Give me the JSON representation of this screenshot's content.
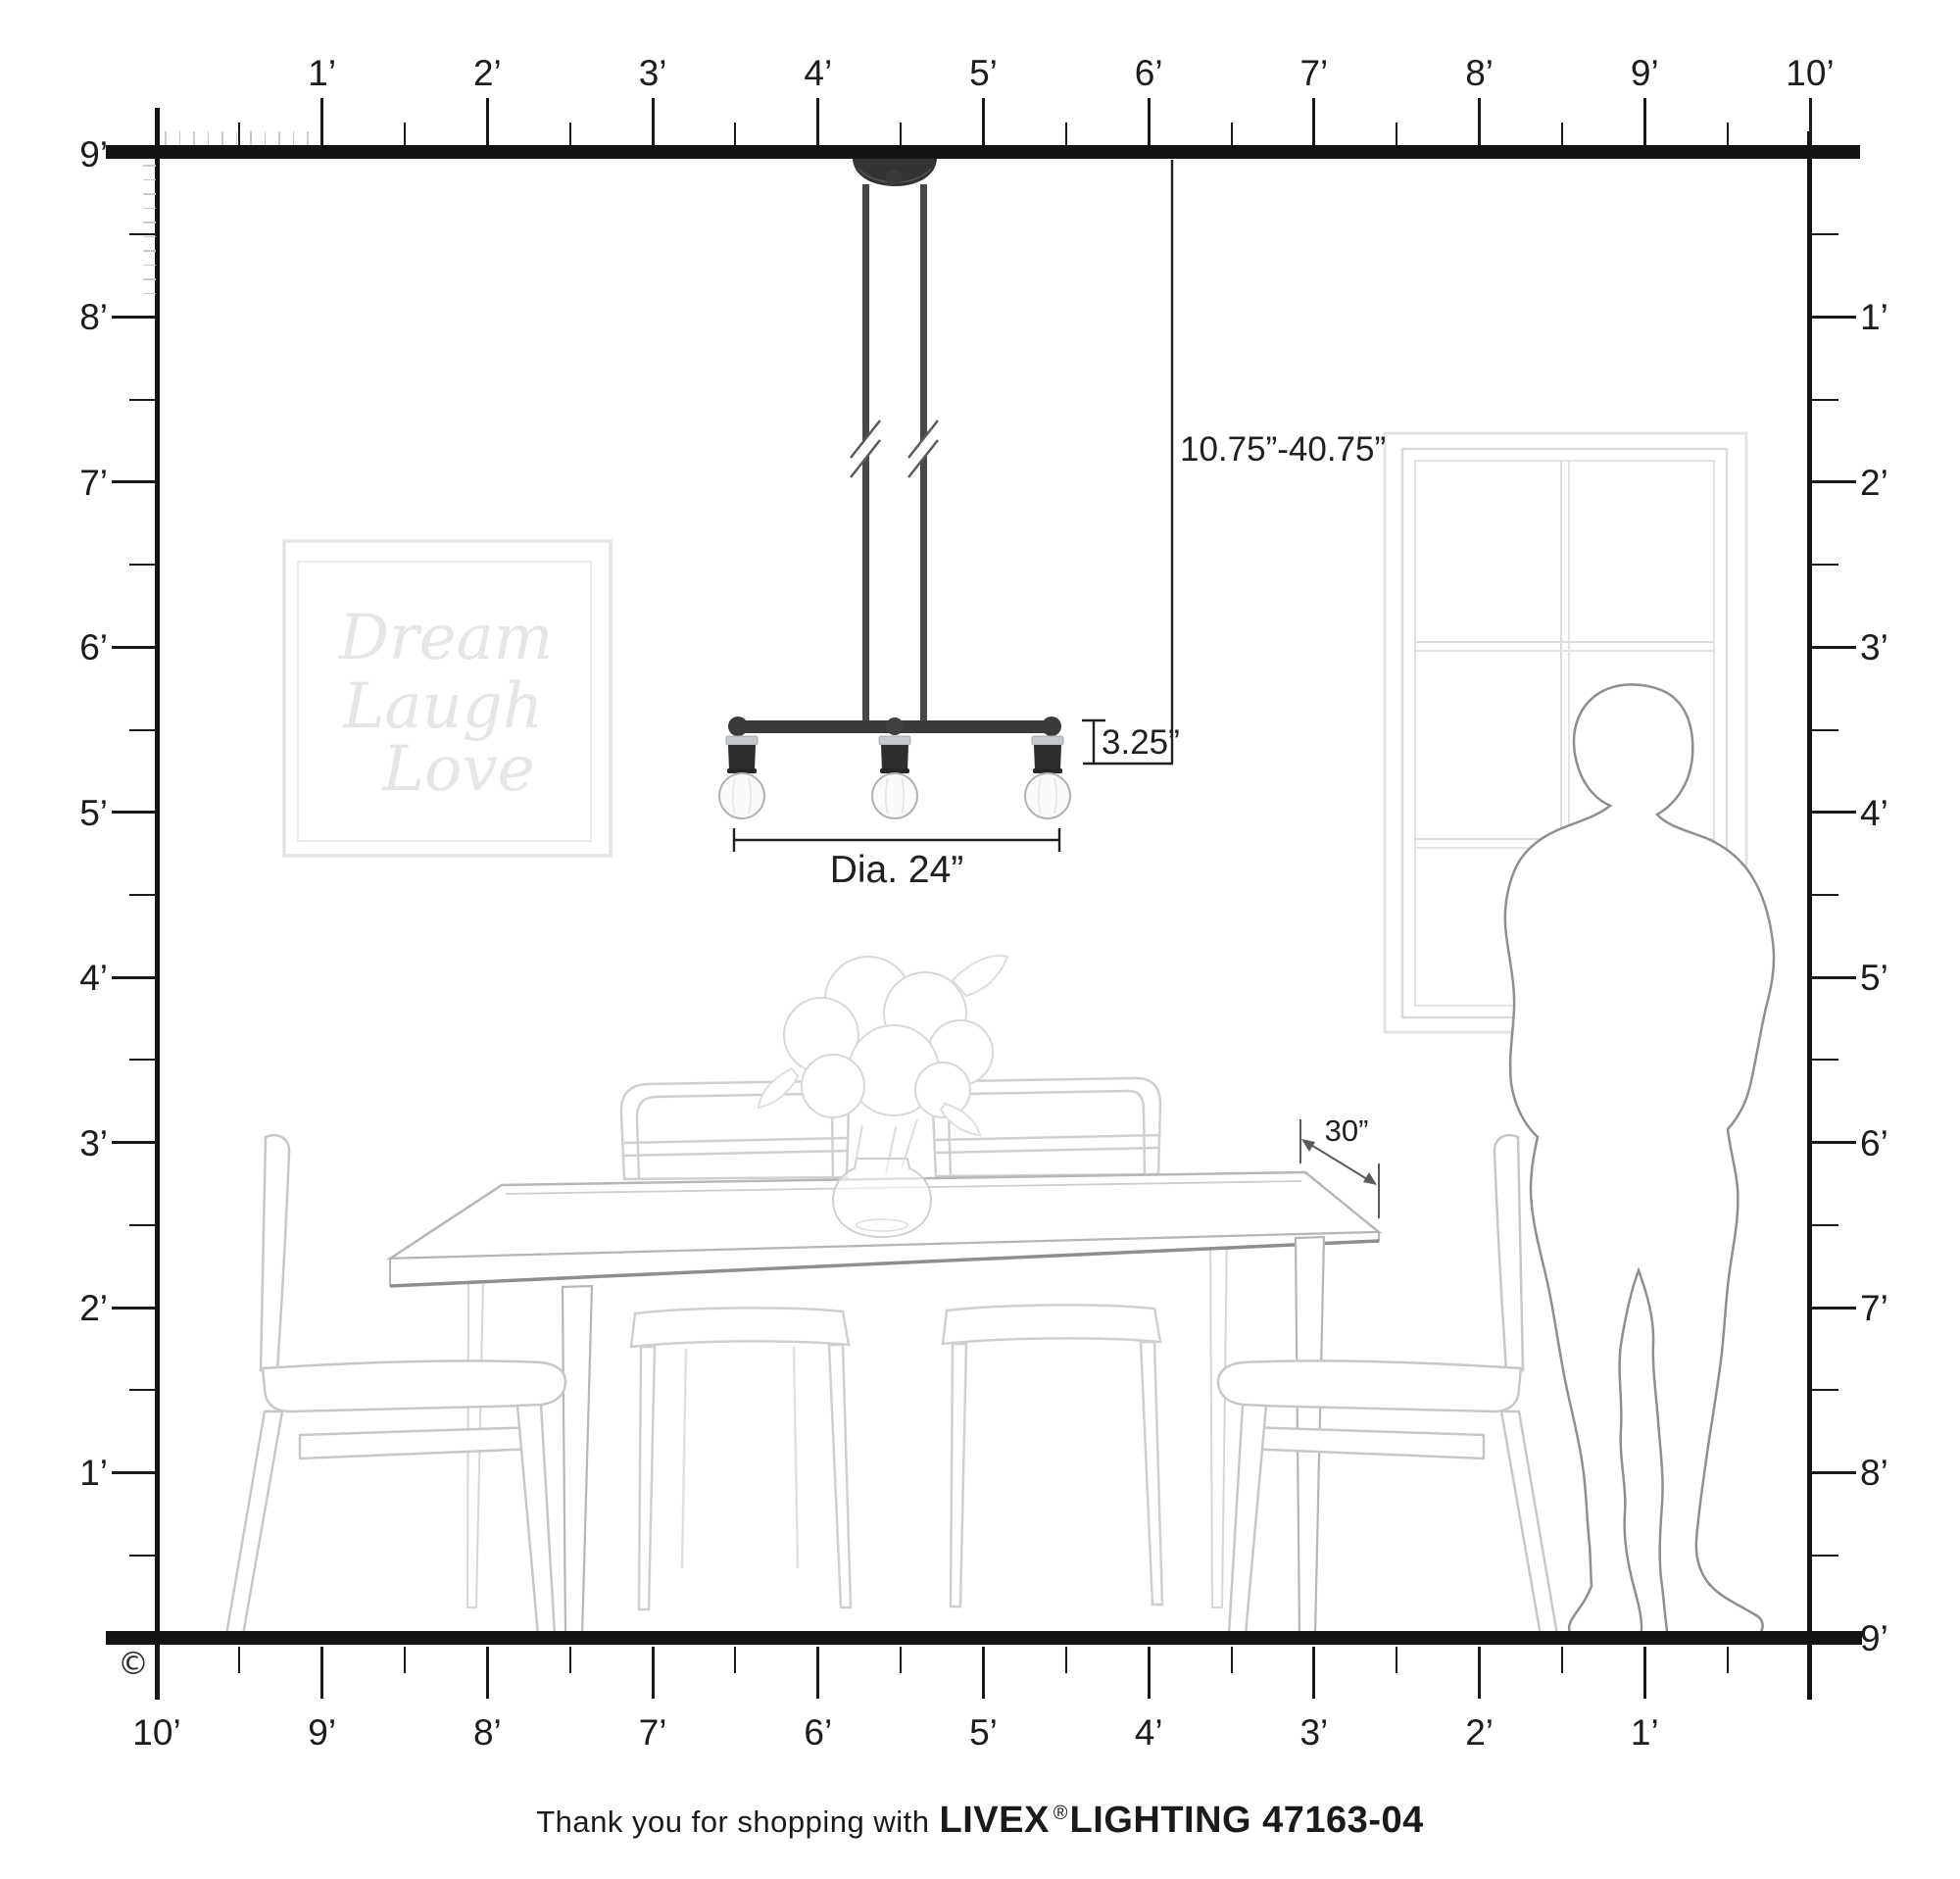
{
  "rulers": {
    "top": [
      "1’",
      "2’",
      "3’",
      "4’",
      "5’",
      "6’",
      "7’",
      "8’",
      "9’",
      "10’"
    ],
    "left": [
      "9’",
      "8’",
      "7’",
      "6’",
      "5’",
      "4’",
      "3’",
      "2’",
      "1’"
    ],
    "right": [
      "1’",
      "2’",
      "3’",
      "4’",
      "5’",
      "6’",
      "7’",
      "8’",
      "9’"
    ],
    "bottom": [
      "10’",
      "9’",
      "8’",
      "7’",
      "6’",
      "5’",
      "4’",
      "3’",
      "2’",
      "1’"
    ]
  },
  "dimensions": {
    "hanging_range": "10.75”-40.75”",
    "body_height": "3.25”",
    "diameter": "Dia. 24”",
    "table_clearance": "30”"
  },
  "wall_art": {
    "line1": "Dream",
    "line2": "Laugh",
    "line3": "Love"
  },
  "footer": {
    "prefix": "Thank you for shopping with",
    "brand": "LIVEX",
    "registered": "®",
    "product": "LIGHTING 47163-04"
  },
  "copyright_symbol": "©",
  "colors": {
    "wall_line": "#141414",
    "dimension_line": "#231f20",
    "fixture_dark": "#3a3a3a",
    "chrome": "#c5c8ca",
    "bulb_fill": "#fafafa",
    "furniture_line": "#c7c7c7",
    "table_edge_line": "#8e8e8e",
    "person_line": "#8f8f8f",
    "window_line": "#dedede",
    "art_frame_line": "#e3e3e3",
    "art_text": "#e6e6e6",
    "minor_tick": "#cbcbcb"
  }
}
